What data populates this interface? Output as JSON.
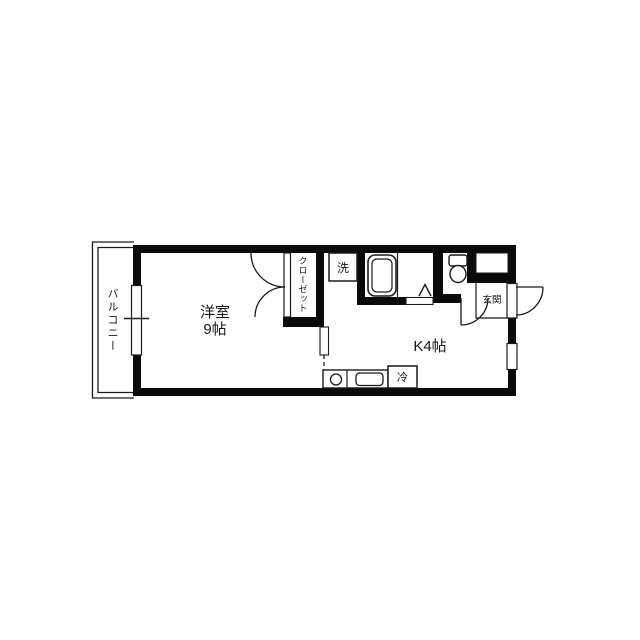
{
  "colors": {
    "background": "#ffffff",
    "walls": "#0a0a0a",
    "thin_lines": "#1a1a1a"
  },
  "rooms": {
    "balcony": {
      "label": "バルコニー"
    },
    "western_room": {
      "label": "洋室",
      "size": "9帖"
    },
    "kitchen": {
      "label": "K4帖"
    },
    "closet": {
      "label": "クローゼット"
    },
    "entrance": {
      "label": "玄関"
    }
  },
  "fixtures": {
    "washing_machine": {
      "label": "洗"
    },
    "refrigerator": {
      "label": "冷"
    },
    "bathtub": {
      "icon": "bathtub-outline"
    },
    "toilet": {
      "icon": "toilet-outline"
    },
    "kitchen_sink": {
      "icon": "sink-rounded-rect"
    },
    "stove_burner": {
      "icon": "burner-circle"
    }
  }
}
